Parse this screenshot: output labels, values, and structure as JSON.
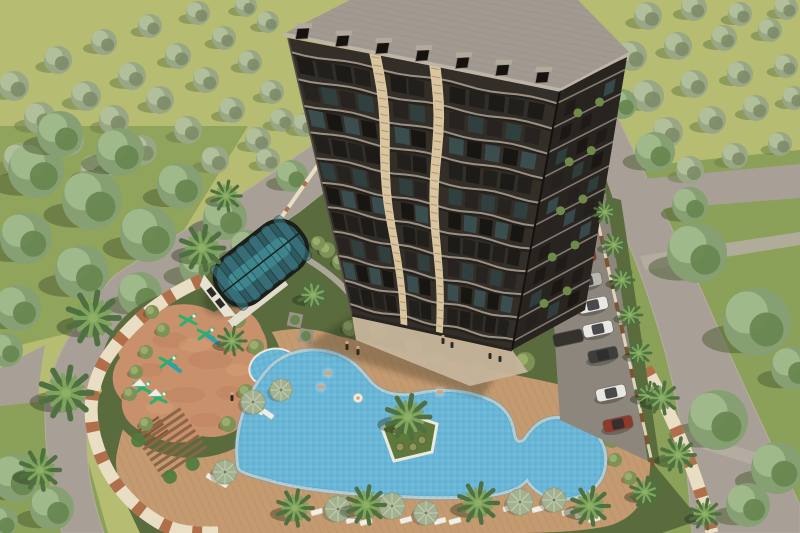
{
  "meta": {
    "description": "Aerial 3D architectural rendering of a residential complex: a dark high-rise apartment tower with wavy cream accent stripes and a tiled roof with dormers, a barrel-vaulted glass atrium over an indoor pool, a free-form blue swimming pool with a palm island and a small round kids pool, a terracotta children's playground with green play equipment, a wooden pergola, sun umbrellas and loungers on a timber deck, a parking strip with cars and carports, cream perimeter walls with palm trees, surrounded by roads and olive groves.",
    "image_type": "3d-render-aerial"
  },
  "palette": {
    "field": "#b6bc72",
    "lawnOuter": "#8ba058",
    "lawnComplex": "#5a6c3d",
    "road": "#a8a096",
    "roadLight": "#b5ada2",
    "asphalt": "#8d867c",
    "deck": "#c49a70",
    "deckLine": "#a87c50",
    "pool": "#6ab6d6",
    "poolDeep": "#4f9dc2",
    "rim": "#ece9de",
    "island": "#5d7a3c",
    "wallCream": "#e9ddc4",
    "wallBrick": "#b06f4b",
    "woodPost": "#7c5335",
    "roofFill": "#a29a90",
    "roofLine": "#8b8379",
    "dormer": "#15120f",
    "dormerCap": "#b3aa9e",
    "fascia": "#beb5a8",
    "facade": "#332e27",
    "facadeB": "#282420",
    "slab": "#9a9085",
    "slabShadow": "#14110e",
    "stripe": "#d9c6a0",
    "stripeRung": "#a78c66",
    "glassFrame": "#1b1f1a",
    "glassTeal1": "#2e5a61",
    "glassTeal2": "#3d7d88",
    "atriumPool": "#41929b",
    "atriumWall": "#e8e2d4",
    "pgGround": "#c8916c",
    "pgDark": "#b5744c",
    "pgLight": "#e0a87e",
    "equipGreen": "#2fae6e",
    "equipTeal": "#2e9fae",
    "white": "#f1eee6",
    "umbrella": "#a3b191",
    "umbrellaRim": "#8d9c7d",
    "umbrellaRib": "#c6cfb4",
    "oliveA": "#9aa785",
    "oliveB": "#b2bf9b",
    "oliveC": "#7d8c68",
    "oliveShadow": "#6f7f48",
    "treeA": "#86a073",
    "treeB": "#a0b98a",
    "treeC": "#67854f",
    "treeShadow": "#4c5c33",
    "palmDark": "#4f7040",
    "palmLight": "#7fa45c",
    "palmCore": "#8fae66",
    "bush": "#7e9157",
    "bushHi": "#9aad6d",
    "carWhite": "#e9e7e1",
    "carRed": "#8d3a2b",
    "carSilver": "#b9b7b2",
    "carDark": "#403e3b",
    "carport": "#35322d",
    "skin": "#d2a482",
    "figDark": "#2e2a26",
    "shadow": "#1b2412",
    "windowGlass": [
      "#1d1b18",
      "#262320",
      "#3a4e50",
      "#22201d",
      "#30403f",
      "#181613"
    ]
  },
  "scene": {
    "terrain": {
      "westBand": "M0,126 L248,126 L130,318 L0,350 Z",
      "eastLawn": "M604,170 L800,150 L800,533 L658,533 L612,238 Z",
      "swCorner": "M0,396 L70,396 L108,533 L0,533 Z",
      "complexLawn": "M96,398 L210,272 L300,212 L558,6 L584,116 L612,196 L652,462 L700,520 L662,533 L140,533 L96,440 Z"
    },
    "roads": {
      "left": "M520,0 L562,0 L300,212 L165,300 Q100,356 88,415 Q82,470 104,533 L62,533 Q44,468 45,405 Q52,344 115,275 L255,185 Z",
      "leftBranch": "M45,345 L0,368 L0,406 L38,402 Q40,370 45,345 Z",
      "right": "M585,118 L618,118 Q652,190 690,264 Q732,362 800,505 L800,533 L692,533 Q686,430 664,348 Q638,256 604,190 Q594,152 585,118 Z",
      "rightBranch": "M610,182 L800,164 L800,198 L622,212 Z",
      "walk1": "M640,256 L800,232 L800,245 L645,270 Z",
      "walk2": "M676,428 L800,466 L800,480 L681,442 Z",
      "parking": "M544,168 L606,194 L650,462 L560,420 Z",
      "greenStrip": "M606,196 L621,200 L660,464 L648,462 Z",
      "gardenPath": "M300,255 Q330,272 348,292 Q360,304 356,318"
    },
    "walls": {
      "nwThin": "M250,262 L330,148 L405,86",
      "striped": "M202,280 C160,298 126,326 104,362 C88,392 88,420 98,448 C108,478 128,504 158,522 C178,534 200,533 218,533",
      "se": "M646,368 Q692,452 712,533",
      "fence": [
        [
          592,
          196
        ],
        [
          652,
          462
        ]
      ]
    },
    "deck": "M118,448 C128,398 156,372 186,356 C216,340 246,332 272,332 C300,326 322,330 338,336 C380,346 440,358 500,372 C550,382 600,392 632,408 C650,420 654,440 650,468 C648,498 636,518 608,526 C570,534 520,533 480,533 L200,533 C160,533 134,512 124,492 C116,476 114,462 118,448 Z",
    "pool": {
      "path": "M238,468 C232,430 248,390 270,367 C288,349 315,347 334,353 C354,359 362,372 372,383 C384,395 402,397 420,393 C446,388 470,391 490,400 C504,406 512,418 514,432 C515,440 518,444 524,440 C532,428 540,420 552,418 C576,415 600,428 605,452 C609,478 593,497 567,499 C548,500 534,492 527,480 C520,489 505,494 485,496 C450,499 420,498 390,496 C350,494 305,490 275,482 C255,476 242,474 238,468 Z",
      "island": {
        "path": "M382,428 L404,413 L437,424 L432,452 L394,461 Z",
        "palm": [
          408,
          417,
          22
        ],
        "shrubs": [
          [
            396,
            432
          ],
          [
            414,
            428
          ],
          [
            422,
            440
          ],
          [
            400,
            447
          ],
          [
            413,
            447
          ]
        ]
      },
      "kids": {
        "cx": 273,
        "cy": 367,
        "rx": 23,
        "ry": 17,
        "rot": -15
      },
      "floatie": [
        358,
        398
      ]
    },
    "playground": {
      "path": "M148,316 C170,300 196,302 214,312 C236,300 256,312 262,330 C272,346 266,362 258,372 C268,390 262,408 248,418 C240,432 220,440 202,436 C186,446 164,444 150,434 C132,430 120,416 122,400 C110,388 110,370 120,358 C112,340 124,324 148,316 Z",
      "lawnRing": {
        "cx": 192,
        "cy": 374,
        "rx": 92,
        "ry": 84
      },
      "mottlesDark": [
        [
          170,
          340,
          18,
          8
        ],
        [
          210,
          360,
          22,
          9
        ],
        [
          185,
          395,
          20,
          8
        ],
        [
          230,
          393,
          14,
          7
        ],
        [
          150,
          370,
          13,
          7
        ],
        [
          206,
          420,
          16,
          7
        ]
      ],
      "mottlesLight": [
        [
          195,
          345,
          16,
          7
        ],
        [
          160,
          408,
          14,
          6
        ],
        [
          238,
          370,
          12,
          6
        ]
      ],
      "equipment": [
        {
          "x": 188,
          "y": 320,
          "t": 0
        },
        {
          "x": 206,
          "y": 334,
          "t": 1
        },
        {
          "x": 168,
          "y": 362,
          "t": 1
        },
        {
          "x": 142,
          "y": 388,
          "t": 2
        },
        {
          "x": 158,
          "y": 398,
          "t": 2
        }
      ],
      "steps": {
        "x": 152,
        "y": 430,
        "rot": -35,
        "n": 5
      }
    },
    "pergola": {
      "cx": 172,
      "cy": 444,
      "rot": -34,
      "slats": 8,
      "len": 54,
      "gap": 6.5
    },
    "atrium": {
      "cx": 261,
      "cy": 263,
      "rot": -38,
      "len": 104,
      "wid": 58
    },
    "building": {
      "roof": [
        [
          283,
          34
        ],
        [
          350,
          0
        ],
        [
          578,
          0
        ],
        [
          630,
          53
        ],
        [
          560,
          90
        ]
      ],
      "quadA": [
        [
          288,
          38
        ],
        [
          560,
          90
        ],
        [
          512,
          350
        ],
        [
          352,
          315
        ]
      ],
      "quadB": [
        [
          560,
          90
        ],
        [
          627,
          57
        ],
        [
          585,
          310
        ],
        [
          512,
          350
        ]
      ],
      "eave": [
        [
          293,
          41
        ],
        [
          556,
          89
        ]
      ],
      "dormers": 7,
      "slabV": [
        0.05,
        0.145,
        0.24,
        0.335,
        0.43,
        0.52,
        0.61,
        0.7,
        0.79,
        0.88,
        0.965
      ],
      "rowV": [
        0.095,
        0.19,
        0.285,
        0.38,
        0.475,
        0.565,
        0.655,
        0.745,
        0.835,
        0.925
      ],
      "colsA": [
        0.045,
        0.118,
        0.19,
        0.262,
        0.4,
        0.468,
        0.625,
        0.7,
        0.775,
        0.85,
        0.925
      ],
      "stripes": [
        0.32,
        0.54
      ],
      "colsB": [
        0.22,
        0.52,
        0.8
      ],
      "plantB": [
        0.36,
        0.68
      ],
      "shadow": "M352,315 L512,350 L482,398 L362,362 L306,346 Z",
      "plaza": "M352,315 L512,350 L528,372 L470,386 L356,340 Z"
    },
    "olives": [
      [
        14,
        86,
        15
      ],
      [
        58,
        60,
        14
      ],
      [
        104,
        42,
        13
      ],
      [
        150,
        26,
        12
      ],
      [
        198,
        13,
        12
      ],
      [
        246,
        6,
        11
      ],
      [
        40,
        118,
        16
      ],
      [
        86,
        96,
        15
      ],
      [
        132,
        76,
        14
      ],
      [
        178,
        56,
        13
      ],
      [
        224,
        38,
        12
      ],
      [
        268,
        22,
        11
      ],
      [
        20,
        160,
        17
      ],
      [
        68,
        140,
        16
      ],
      [
        114,
        120,
        15
      ],
      [
        160,
        100,
        14
      ],
      [
        206,
        80,
        13
      ],
      [
        250,
        62,
        12
      ],
      [
        96,
        170,
        16
      ],
      [
        142,
        150,
        15
      ],
      [
        188,
        130,
        14
      ],
      [
        232,
        110,
        13
      ],
      [
        272,
        92,
        12
      ],
      [
        215,
        160,
        14
      ],
      [
        258,
        140,
        13
      ],
      [
        282,
        120,
        12
      ],
      [
        648,
        16,
        14
      ],
      [
        694,
        8,
        13
      ],
      [
        740,
        14,
        12
      ],
      [
        786,
        8,
        12
      ],
      [
        632,
        56,
        15
      ],
      [
        678,
        46,
        14
      ],
      [
        724,
        38,
        13
      ],
      [
        770,
        30,
        12
      ],
      [
        648,
        96,
        16
      ],
      [
        694,
        84,
        14
      ],
      [
        740,
        74,
        13
      ],
      [
        786,
        66,
        12
      ],
      [
        668,
        132,
        15
      ],
      [
        712,
        120,
        14
      ],
      [
        756,
        108,
        13
      ],
      [
        794,
        98,
        12
      ],
      [
        690,
        170,
        14
      ],
      [
        735,
        156,
        13
      ],
      [
        780,
        144,
        12
      ],
      [
        268,
        160,
        12
      ],
      [
        305,
        125,
        12
      ],
      [
        342,
        92,
        11
      ]
    ],
    "forest": [
      [
        36,
        170,
        28
      ],
      [
        92,
        200,
        30
      ],
      [
        148,
        234,
        28
      ],
      [
        204,
        264,
        25
      ],
      [
        26,
        238,
        26
      ],
      [
        82,
        272,
        27
      ],
      [
        18,
        308,
        23
      ],
      [
        140,
        294,
        22
      ],
      [
        225,
        218,
        22
      ],
      [
        180,
        186,
        23
      ],
      [
        120,
        152,
        24
      ],
      [
        60,
        134,
        23
      ],
      [
        248,
        248,
        18
      ],
      [
        6,
        350,
        17
      ],
      [
        292,
        176,
        16
      ],
      [
        16,
        478,
        24
      ],
      [
        52,
        508,
        22
      ],
      [
        2,
        522,
        16
      ],
      [
        697,
        253,
        30
      ],
      [
        757,
        322,
        34
      ],
      [
        718,
        420,
        30
      ],
      [
        777,
        468,
        26
      ],
      [
        793,
        368,
        22
      ],
      [
        655,
        152,
        20
      ],
      [
        690,
        205,
        18
      ],
      [
        748,
        505,
        22
      ],
      [
        622,
        104,
        15
      ]
    ],
    "palms": [
      [
        93,
        318,
        26
      ],
      [
        66,
        393,
        26
      ],
      [
        40,
        470,
        20
      ],
      [
        202,
        248,
        22
      ],
      [
        226,
        196,
        15
      ],
      [
        232,
        341,
        14
      ],
      [
        313,
        295,
        15
      ],
      [
        295,
        508,
        18
      ],
      [
        366,
        505,
        19
      ],
      [
        478,
        503,
        20
      ],
      [
        590,
        506,
        19
      ],
      [
        645,
        492,
        15
      ],
      [
        614,
        245,
        12
      ],
      [
        622,
        280,
        12
      ],
      [
        630,
        315,
        12
      ],
      [
        639,
        353,
        12
      ],
      [
        648,
        395,
        13
      ],
      [
        662,
        398,
        16
      ],
      [
        678,
        455,
        17
      ],
      [
        705,
        514,
        15
      ],
      [
        605,
        212,
        11
      ]
    ],
    "bushes": [
      [
        378,
        330,
        9
      ],
      [
        438,
        362,
        10
      ],
      [
        478,
        372,
        9
      ],
      [
        525,
        362,
        10
      ],
      [
        570,
        315,
        10
      ],
      [
        592,
        340,
        9
      ],
      [
        570,
        432,
        9
      ],
      [
        600,
        412,
        9
      ],
      [
        586,
        375,
        9
      ],
      [
        612,
        440,
        8
      ],
      [
        152,
        312,
        7
      ],
      [
        163,
        330,
        7
      ],
      [
        146,
        352,
        7
      ],
      [
        136,
        372,
        7
      ],
      [
        130,
        394,
        7
      ],
      [
        146,
        424,
        7
      ],
      [
        238,
        320,
        8
      ],
      [
        256,
        347,
        8
      ],
      [
        246,
        392,
        8
      ],
      [
        228,
        424,
        8
      ],
      [
        327,
        250,
        8
      ],
      [
        340,
        262,
        8
      ],
      [
        318,
        243,
        7
      ],
      [
        598,
        186,
        8
      ],
      [
        588,
        170,
        8
      ],
      [
        615,
        460,
        7
      ],
      [
        630,
        478,
        7
      ],
      [
        641,
        496,
        7
      ],
      [
        413,
        347,
        9
      ],
      [
        350,
        328,
        8
      ]
    ],
    "planters": [
      [
        295,
        320
      ],
      [
        306,
        336
      ]
    ],
    "umbrellas": [
      [
        253,
        402,
        12
      ],
      [
        281,
        390,
        11
      ],
      [
        225,
        472,
        12
      ],
      [
        338,
        509,
        13
      ],
      [
        392,
        506,
        13
      ],
      [
        426,
        513,
        12
      ],
      [
        520,
        502,
        13
      ],
      [
        554,
        500,
        12
      ]
    ],
    "loungers": [
      [
        248,
        405,
        35
      ],
      [
        258,
        410,
        35
      ],
      [
        268,
        414,
        35
      ],
      [
        212,
        478,
        30
      ],
      [
        222,
        483,
        30
      ],
      [
        317,
        512,
        -15
      ],
      [
        352,
        520,
        -15
      ],
      [
        366,
        522,
        -15
      ],
      [
        406,
        520,
        -15
      ],
      [
        440,
        521,
        -15
      ],
      [
        455,
        521,
        -15
      ],
      [
        509,
        508,
        -15
      ],
      [
        538,
        509,
        -15
      ],
      [
        568,
        512,
        -15
      ],
      [
        581,
        515,
        -15
      ],
      [
        594,
        519,
        -15
      ]
    ],
    "cars": [
      [
        566,
        224,
        "carWhite"
      ],
      [
        581,
        257,
        "carRed"
      ],
      [
        587,
        281,
        "carSilver"
      ],
      [
        593,
        305,
        "carWhite"
      ],
      [
        598,
        329,
        "carWhite"
      ],
      [
        603,
        355,
        "carDark"
      ],
      [
        611,
        393,
        "carWhite"
      ],
      [
        618,
        424,
        "carRed"
      ]
    ],
    "carports": [
      [
        552,
        178
      ],
      [
        555,
        210
      ],
      [
        558,
        242
      ],
      [
        561,
        274
      ],
      [
        564,
        306
      ],
      [
        568,
        338
      ]
    ],
    "figures": {
      "walkers": [
        [
          347,
          346
        ],
        [
          358,
          351
        ],
        [
          443,
          340
        ],
        [
          452,
          344
        ],
        [
          490,
          355
        ],
        [
          500,
          358
        ],
        [
          232,
          397
        ]
      ],
      "swimmers": [
        [
          328,
          373
        ],
        [
          321,
          387
        ],
        [
          440,
          392
        ]
      ]
    }
  }
}
